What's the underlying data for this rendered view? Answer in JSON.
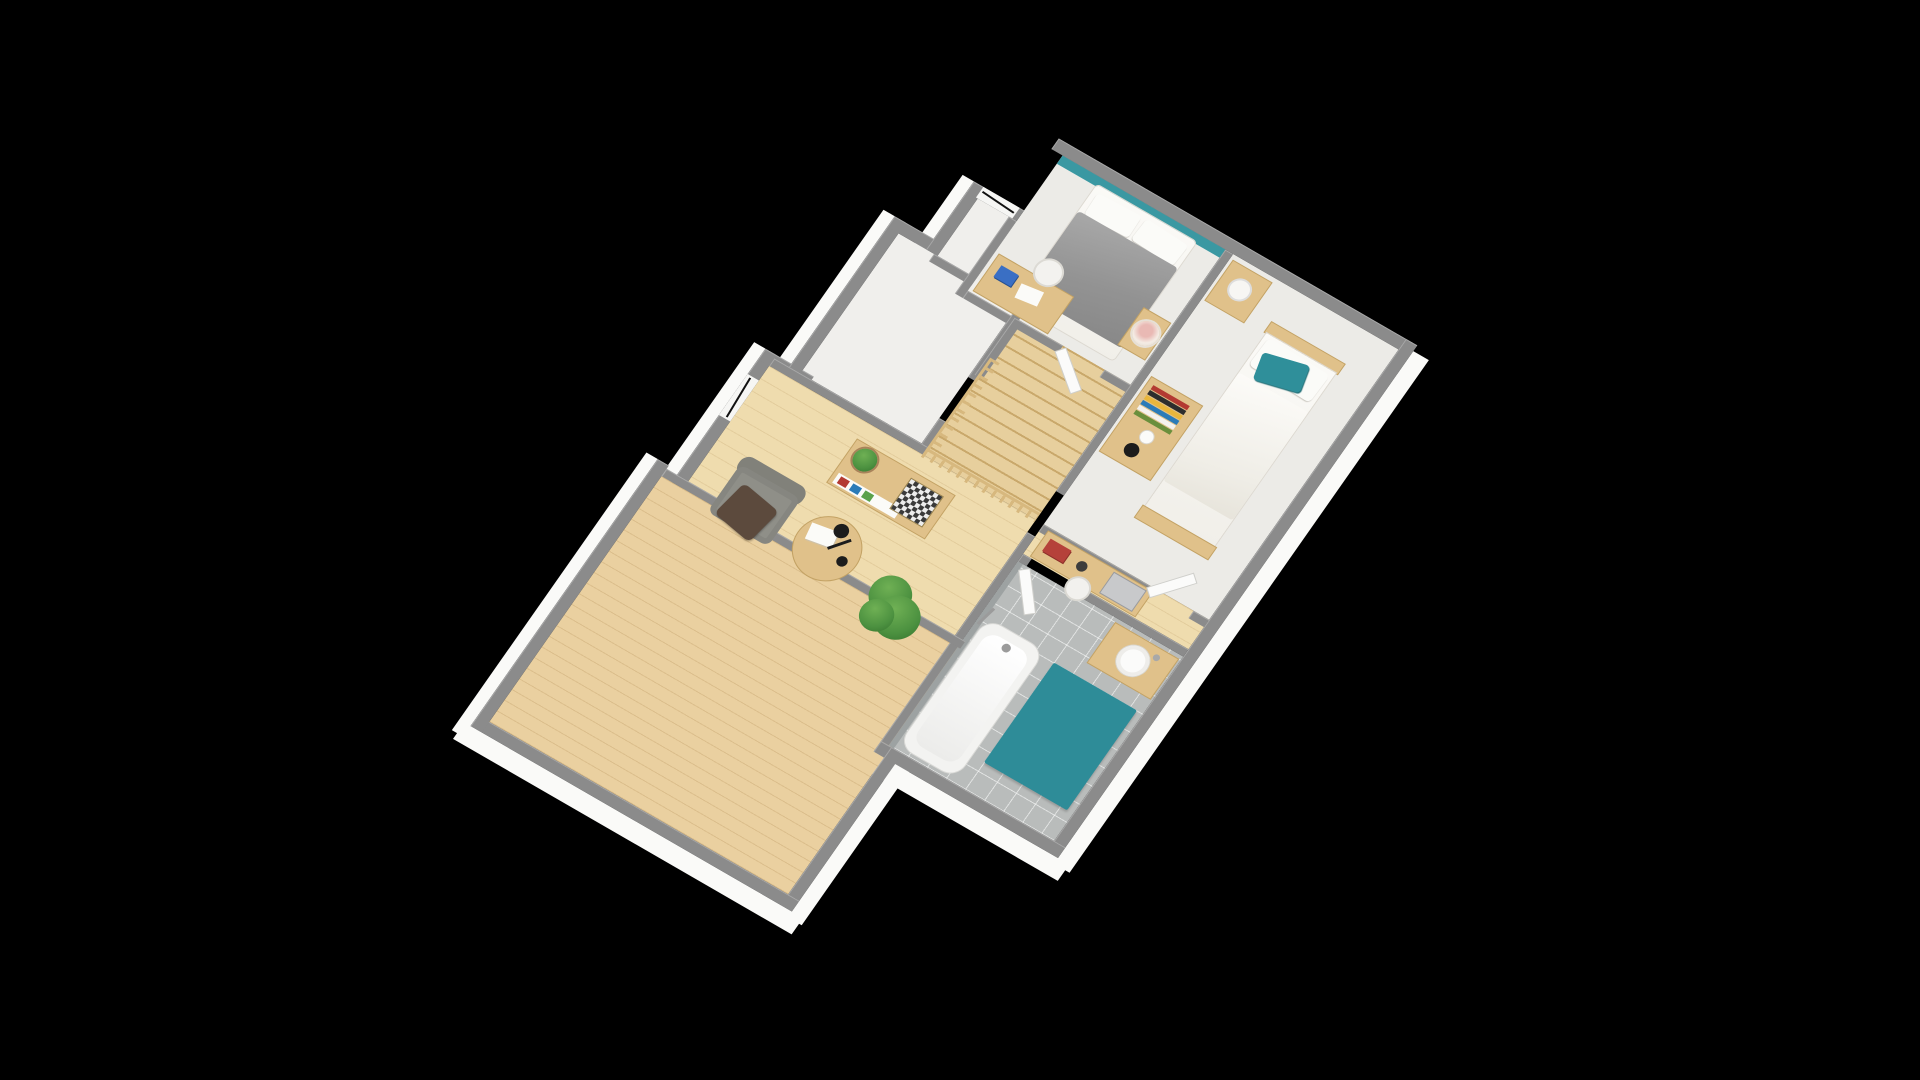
{
  "scene": {
    "type": "3d-floorplan-render",
    "description": "Isometric 3D render of an upper-storey house floor plan on a black background, rotated with the long axis running from lower-left to upper-right",
    "background": "#000000"
  },
  "palette": {
    "bg": "#000000",
    "wallGray": "#8b8b8b",
    "skirt": "#fafaf8",
    "carpet": "#ecebe7",
    "carpetEntry": "#f0efec",
    "woodHall": "#efdcae",
    "woodBig": "#ead0a0",
    "stairWood": "#e7cf9d",
    "stairGrain": "#c9a86b",
    "railWood": "#d7b87e",
    "tileFloor": "#b9bcbb",
    "tileWall": "#9da2a2",
    "teal": "#3a98a2",
    "tealRug": "#2e8c98",
    "tealPillow": "#2f8f9a",
    "furnWood": "#e0c18a",
    "furnWoodEdge": "#c3a264",
    "duvet": "#939393",
    "duvetHi": "#a8a8a8",
    "duvetLo": "#888888",
    "bedding": "#f1efe9",
    "pillowWhite": "#fbfbf8",
    "chairFabric": "#8f8f88",
    "chairFabricDark": "#81817a",
    "blanket": "#5c4a3d",
    "plantGreen": "#4c9140",
    "plantLight": "#6fb054",
    "plantDark": "#33702c",
    "lampBlack": "#1c1c1c",
    "bookBlue": "#3a6fc4",
    "bookRed": "#b5413a",
    "laptop": "#c8c9cb",
    "doorWhite": "#fbfbfa",
    "doorEdge": "#cfcfcb",
    "windowGlass": "#f6f6f4",
    "windowFrame": "#111111",
    "chessDark": "#3a3a3a",
    "chessLight": "#ededed"
  },
  "rooms": [
    {
      "id": "master-bedroom",
      "floor": "carpet",
      "feature": "teal accent wall on north side, double bed with gray duvet, desk with blue book, white chair, glass terrarium bowl"
    },
    {
      "id": "bedroom-2",
      "floor": "carpet",
      "feature": "single bed with teal pillow along east wall, wooden dresser with books, nightstand with lamp, desk with laptop in south alcove"
    },
    {
      "id": "storage-room",
      "floor": "carpet",
      "feature": "empty white-floored room, north-west side"
    },
    {
      "id": "entry-nook",
      "floor": "carpet",
      "feature": "small recess with black-framed window"
    },
    {
      "id": "landing-staircase",
      "floor": "wood",
      "feature": "wooden staircase with balustrade railing around the stairwell"
    },
    {
      "id": "study-sitting-area",
      "floor": "wood",
      "feature": "sideboard with chessboard and potted plant, round table with black desk lamp and papers, gray armchair with brown throw, large floor plant, window on west wall"
    },
    {
      "id": "bathroom",
      "floor": "gray-tile",
      "feature": "bathtub on west side, teal rug, wooden vanity with round white basin, white door ajar"
    },
    {
      "id": "large-room",
      "floor": "wood",
      "feature": "large empty room at the south-west with plank flooring"
    }
  ],
  "furniture": [
    "double-bed",
    "white-pillows",
    "gray-duvet",
    "master-desk",
    "blue-book",
    "white-desk-chair",
    "glass-terrarium-bowl",
    "foot-table",
    "master-door",
    "single-bed",
    "teal-pillow",
    "bed-headboard",
    "bed-footboard",
    "nightstand",
    "white-table-lamp",
    "dresser",
    "book-row",
    "white-vase",
    "black-lamp",
    "alcove-desk",
    "red-book",
    "black-cup",
    "silver-laptop",
    "alcove-chair",
    "bedroom2-door",
    "bathtub",
    "bath-faucet",
    "teal-rug",
    "vanity-cabinet",
    "round-basin",
    "bathroom-door",
    "sideboard",
    "chessboard",
    "potted-plant-small",
    "round-table",
    "paper-sheets",
    "desk-lamp-black",
    "armchair",
    "brown-throw-blanket",
    "floor-plant-large",
    "staircase-treads",
    "stair-railing",
    "window-north",
    "window-west"
  ],
  "projection": {
    "note": "affine isometric-style camera, plan x-axis maps to screen direction 30deg down-right, plan y-axis to 55deg down-left",
    "matrix": [
      0.866,
      0.5,
      -0.574,
      0.819,
      937,
      83
    ]
  }
}
